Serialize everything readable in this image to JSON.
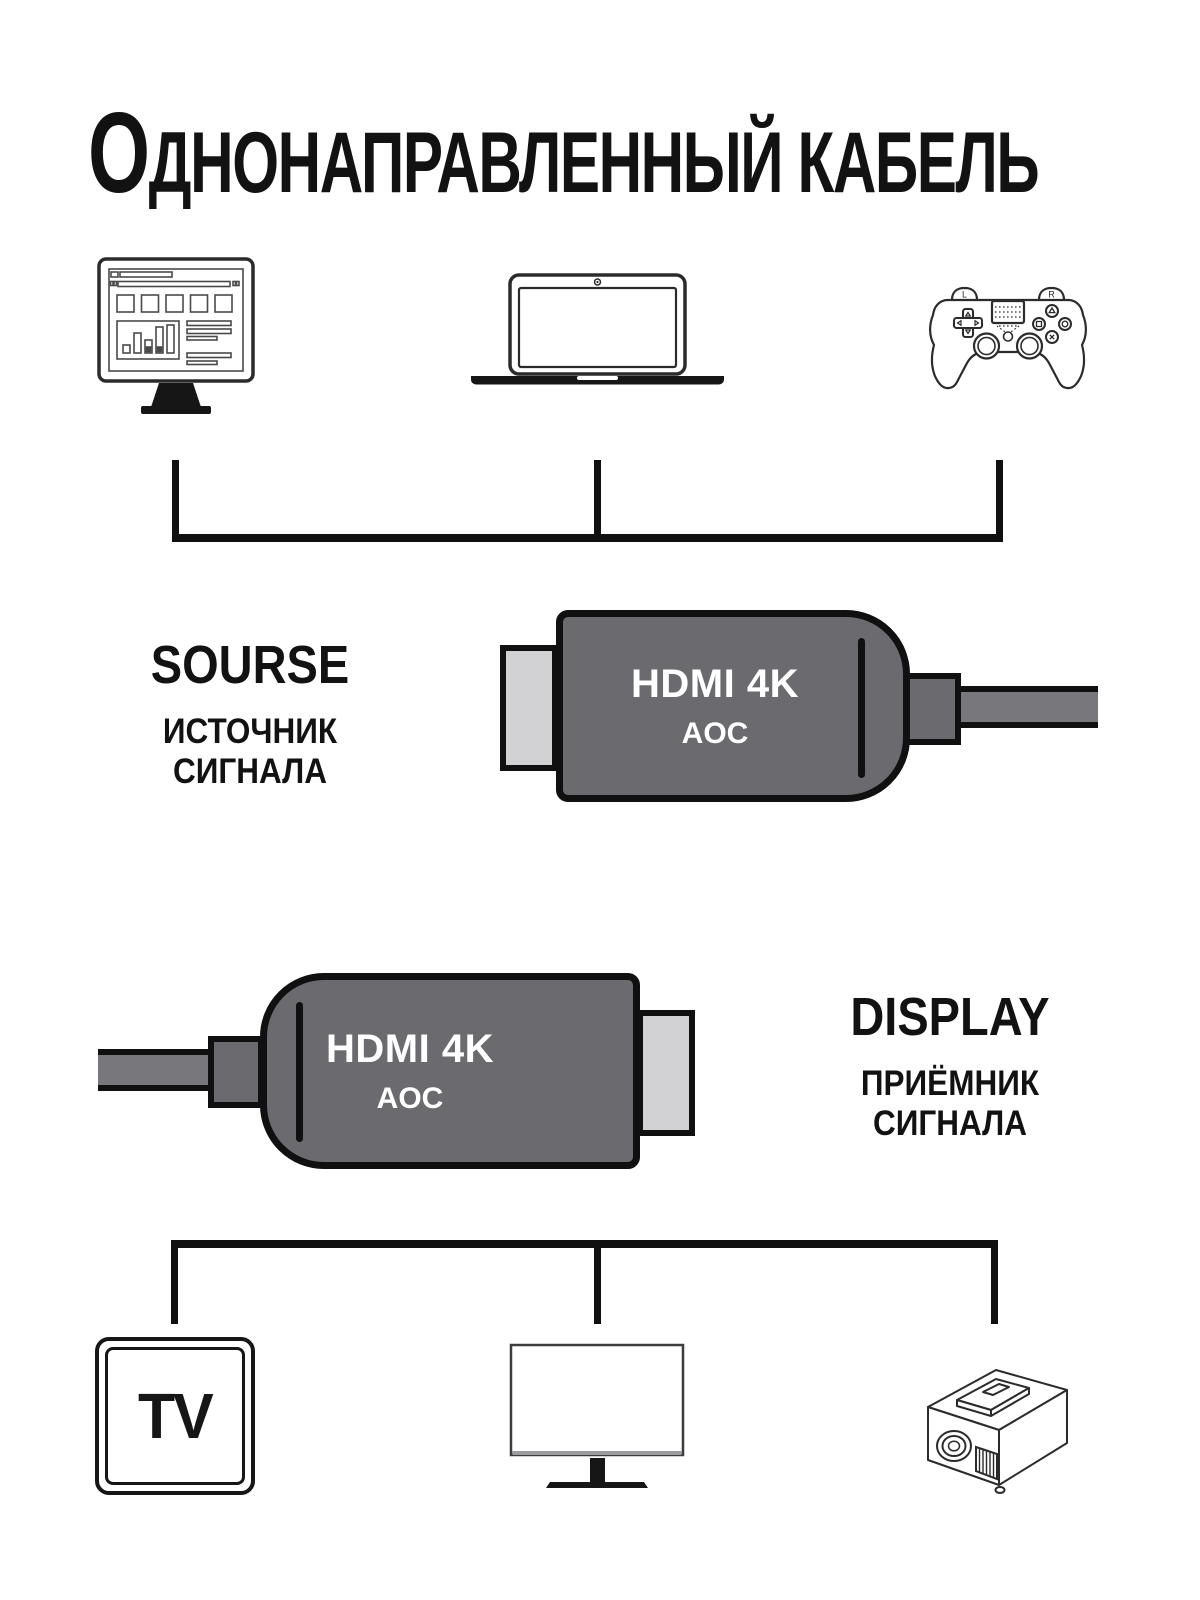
{
  "title": {
    "lead": "О",
    "rest": "ДНОНАПРАВЛЕННЫЙ КАБЕЛЬ"
  },
  "source": {
    "label": "SOURSE",
    "sublabel": "ИСТОЧНИК СИГНАЛА"
  },
  "display": {
    "label": "DISPLAY",
    "sublabel": "ПРИЁМНИК СИГНАЛА"
  },
  "connector_source": {
    "line1": "HDMI 4K",
    "line2": "AOC"
  },
  "connector_display": {
    "line1": "HDMI 4K",
    "line2": "AOC"
  },
  "icons": {
    "tv_label": "TV",
    "gamepad_left": "L",
    "gamepad_right": "R",
    "source_devices": [
      "desktop-computer",
      "laptop",
      "game-controller"
    ],
    "display_devices": [
      "tv",
      "monitor",
      "projector"
    ]
  },
  "colors": {
    "connector_body": "#6b6b6f",
    "connector_plug": "#d2d2d5",
    "cable": "#78787c",
    "outline": "#101010",
    "connector_text": "#ffffff",
    "ink": "#121212"
  }
}
